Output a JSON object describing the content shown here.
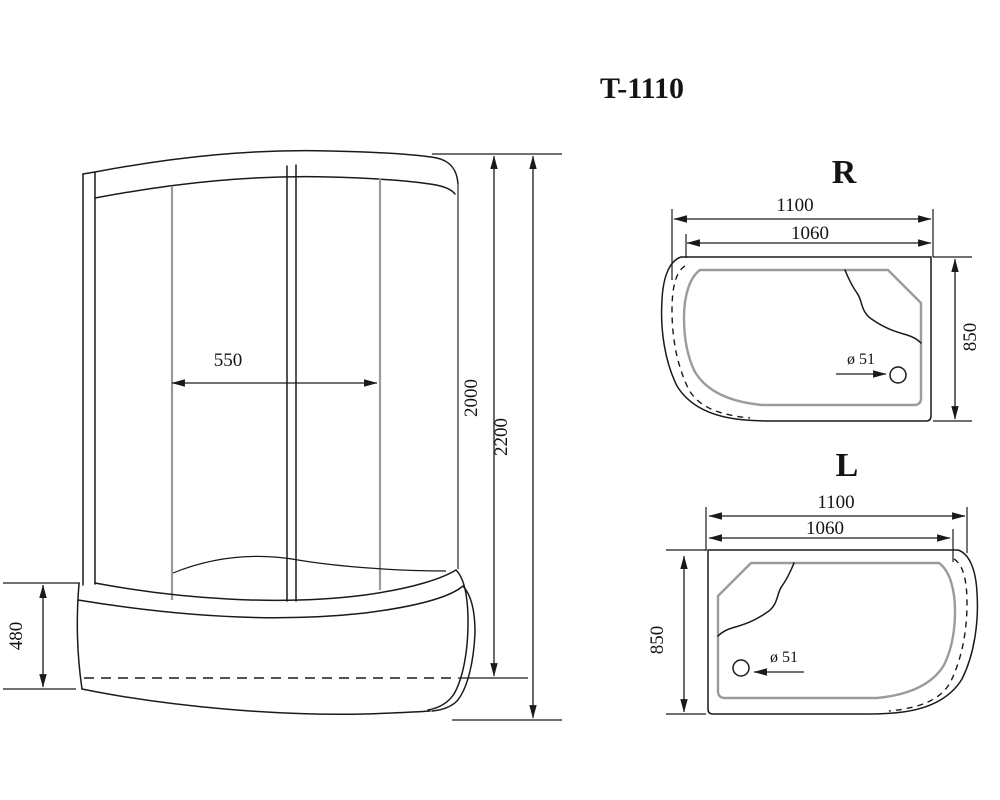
{
  "drawing": {
    "title": "T-1110",
    "front_view": {
      "door_width": "550",
      "cabin_height": "2000",
      "total_height": "2200",
      "tray_height": "480"
    },
    "right_view": {
      "label": "R",
      "overall_width": "1100",
      "inner_width": "1060",
      "depth": "850",
      "drain_diameter": "ø 51"
    },
    "left_view": {
      "label": "L",
      "overall_width": "1100",
      "inner_width": "1060",
      "depth": "850",
      "drain_diameter": "ø 51"
    },
    "colors": {
      "line": "#1a1a1a",
      "secondary_line": "#9b9b9b",
      "background": "#ffffff"
    }
  }
}
